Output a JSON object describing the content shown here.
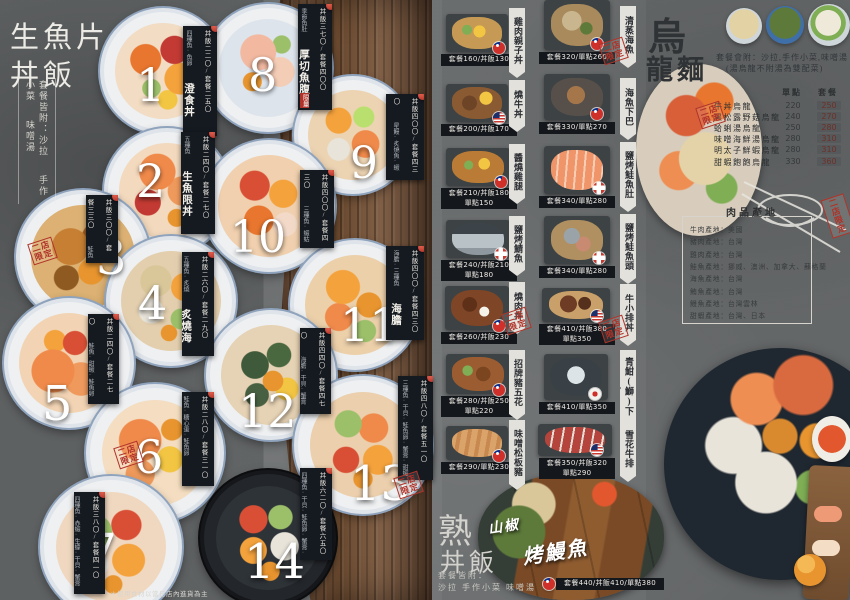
{
  "left": {
    "title_line1": "生魚片",
    "title_line2": "丼飯",
    "note_lines": [
      "套餐皆附：沙拉",
      "手作小菜",
      "味噌湯"
    ],
    "footnote": "＊使用食材以當日店內進貨為主",
    "items": [
      {
        "num": "1",
        "name": "澄食丼",
        "price": "丼飯二二〇/套餐二五〇",
        "note": "四種魚·魚卵"
      },
      {
        "num": "2",
        "name": "生魚限丼",
        "price": "丼飯二四〇/套餐二七〇",
        "note": "五種魚"
      },
      {
        "num": "3",
        "name": "焦糖鮭丼",
        "price": "丼飯三〇〇/套餐三三〇",
        "note": "鮭魚六片"
      },
      {
        "num": "4",
        "name": "炙燒海人丼",
        "price": "丼飯二六〇/套餐二九〇",
        "note": "五種魚·炙燒"
      },
      {
        "num": "5",
        "name": "雙鮭丼",
        "price": "丼飯二四〇/套餐二七〇",
        "note": "鮭魚·甜蝦·鮭魚卵·蝦卵"
      },
      {
        "num": "6",
        "name": "鮭親子丼",
        "price": "丼飯二八〇/套餐三一〇",
        "note": "鮭魚·糖心蛋·鮭魚卵"
      },
      {
        "num": "7",
        "name": "大澄食丼",
        "price": "丼飯三八〇/套餐四一〇",
        "note": "四種魚·赤蝦·生蠔·干貝·蟹膏"
      },
      {
        "num": "8",
        "name": "厚切魚腹丼",
        "price": "丼飯三七〇/套餐四〇〇",
        "note": "季節魚肚"
      },
      {
        "num": "9",
        "name": "融化丼",
        "price": "丼飯四〇〇/套餐四三〇",
        "note": "星鰻·炙燒魚·蝦卵·鮭魚卵"
      },
      {
        "num": "10",
        "name": "蝦蛄丼",
        "price": "丼飯四〇〇/套餐四三〇",
        "note": "三種魚·蝦蛄·甜蝦"
      },
      {
        "num": "11",
        "name": "海膽三色丼",
        "price": "丼飯四〇〇/套餐四三〇",
        "note": "海膽·三種魚"
      },
      {
        "num": "12",
        "name": "海膽干貝蟹膏丼",
        "price": "丼飯四四〇/套餐四七〇",
        "note": "海膽·干貝·蟹膏·鮭魚卵"
      },
      {
        "num": "13",
        "name": "海神丼",
        "price": "丼飯四八〇/套餐五一〇",
        "note": "三種魚·干貝·鮭魚卵·蟹膏·甜蝦·海膽"
      },
      {
        "num": "14",
        "name": "大人物丼",
        "price": "丼飯六二〇/套餐六五〇",
        "note": "四種魚·干貝·鮭魚卵·蟹膏·牡丹蝦·海膽·雙生蠔"
      }
    ]
  },
  "middle": {
    "items_a": [
      {
        "name": "雞肉親子丼",
        "price1": "套餐160/丼飯130",
        "price2": ""
      },
      {
        "name": "燒牛丼",
        "price1": "套餐200/丼飯170",
        "price2": ""
      },
      {
        "name": "醬燒雞腿",
        "price1": "套餐210/丼飯180",
        "price2": "單點150"
      },
      {
        "name": "鹽烤鯖魚",
        "price1": "套餐240/丼飯210",
        "price2": "單點180"
      },
      {
        "name": "燒肉丼",
        "price1": "套餐260/丼飯230",
        "price2": ""
      },
      {
        "name": "招牌豬五花",
        "price1": "套餐280/丼飯250",
        "price2": "單點220"
      },
      {
        "name": "味噌松板豬",
        "price1": "套餐290/單點230",
        "price2": ""
      }
    ],
    "items_b": [
      {
        "name": "清蒸海魚",
        "price1": "套餐320/單點260",
        "price2": ""
      },
      {
        "name": "海魚下巴",
        "price1": "套餐330/單點270",
        "price2": ""
      },
      {
        "name": "鹽烤鮭魚肚",
        "price1": "套餐340/單點280",
        "price2": ""
      },
      {
        "name": "鹽烤鮭魚頭",
        "price1": "套餐340/單點280",
        "price2": ""
      },
      {
        "name": "牛小排丼",
        "price1": "套餐410/丼飯380",
        "price2": "單點350"
      },
      {
        "name": "青魽(鰤)下巴",
        "price1": "套餐410/單點350",
        "price2": ""
      },
      {
        "name": "雪花牛排",
        "price1": "套餐350/丼飯320",
        "price2": "單點290"
      }
    ]
  },
  "udon": {
    "title_line1": "烏",
    "title_line2": "龍麵",
    "note1": "套餐會附：沙拉,手作小菜,味噌湯",
    "note2": "(湯烏龍不附湯為雙配菜)",
    "col_single": "單點",
    "col_set": "套餐",
    "rows": [
      {
        "name": "牛丼烏龍",
        "single": "220",
        "set": "250"
      },
      {
        "name": "黑松露野菇烏龍",
        "single": "240",
        "set": "270"
      },
      {
        "name": "蛤蜊湯烏龍",
        "single": "250",
        "set": "280"
      },
      {
        "name": "味噌海鮮湯烏龍",
        "single": "280",
        "set": "310"
      },
      {
        "name": "明太子鮮蝦烏龍",
        "single": "280",
        "set": "310"
      },
      {
        "name": "甜蝦飽飽烏龍",
        "single": "330",
        "set": "360"
      }
    ],
    "origin_title": "肉品產地",
    "origin_lines": [
      "牛肉產地：美國",
      "豬肉產地：台灣",
      "雞肉產地：台灣",
      "鮭魚產地：挪威、澳洲、加拿大、蘇格蘭",
      "海魚產地：台灣",
      "鮪魚產地：台灣",
      "鰻魚產地：台灣雲林",
      "甜蝦產地：台灣、日本"
    ]
  },
  "cooked": {
    "title_line1": "熟",
    "title_line2": "丼飯",
    "note1": "套餐皆附：",
    "note2": "沙拉 手作小菜 味噌湯",
    "eel_name1": "山椒",
    "eel_name2": "烤鰻魚",
    "eel_price": "套餐440/丼飯410/單點380"
  },
  "badges": {
    "stamp_line1": "二店",
    "stamp_line2": "限定",
    "limited": "限量"
  }
}
